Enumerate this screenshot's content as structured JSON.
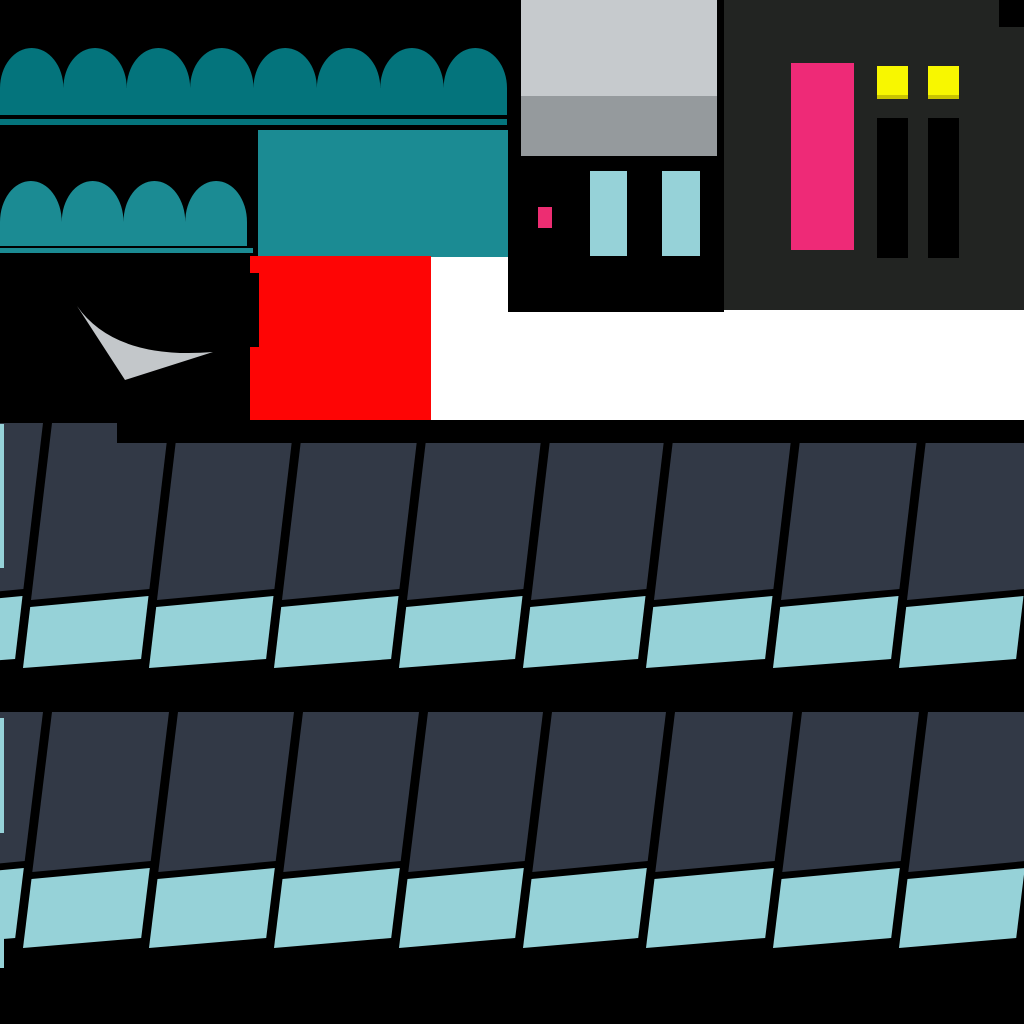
{
  "palette": {
    "black": "#000000",
    "white": "#ffffff",
    "awning_dark": "#04747c",
    "awning_mid": "#1b8b93",
    "canopy": "#1b8b93",
    "window_light": "#c6cacd",
    "window_mid": "#959a9d",
    "building": "#222422",
    "door_pink": "#ee2a77",
    "window_yellow": "#f8f700",
    "yellow_shade": "#c9c400",
    "interior_pink": "#ed2d72",
    "interior_teal": "#96d2d8",
    "red": "#fe0505",
    "triangle_gray": "#c3c7ca",
    "panel_dark": "#323946",
    "panel_teal": "#96d2d8"
  },
  "canvas": {
    "width": 1024,
    "height": 1024
  },
  "white_backdrop": {
    "x": 431,
    "y": 255,
    "w": 593,
    "h": 165,
    "fill": "white"
  },
  "awning_large": {
    "x": 0,
    "span": 507,
    "bumps": 8,
    "top": 48,
    "valley": 88,
    "base_bottom": 115,
    "fill": "awning_dark",
    "underline": {
      "x": 0,
      "y": 119,
      "w": 507,
      "h": 6
    }
  },
  "awning_small": {
    "x": 0,
    "span": 247,
    "bumps": 4,
    "top": 181,
    "valley": 222,
    "base_bottom": 246,
    "fill": "awning_mid",
    "underline": {
      "x": 0,
      "y": 248,
      "w": 253,
      "h": 5
    }
  },
  "canopy_rect": {
    "x": 258,
    "y": 130,
    "w": 252,
    "h": 127,
    "fill": "canopy"
  },
  "storefront": {
    "frame": {
      "x": 508,
      "y": 0,
      "w": 216,
      "h": 312,
      "fill": "black"
    },
    "pane_top": {
      "x": 521,
      "y": 0,
      "w": 196,
      "h": 96,
      "fill": "window_light"
    },
    "pane_bottom": {
      "x": 521,
      "y": 96,
      "w": 196,
      "h": 60,
      "fill": "window_mid"
    },
    "pink_box": {
      "x": 538,
      "y": 207,
      "w": 14,
      "h": 21,
      "fill": "interior_pink"
    },
    "teal_bars": [
      {
        "x": 590,
        "y": 171,
        "w": 37,
        "h": 85,
        "fill": "interior_teal"
      },
      {
        "x": 662,
        "y": 171,
        "w": 38,
        "h": 85,
        "fill": "interior_teal"
      }
    ]
  },
  "building": {
    "body": {
      "x": 724,
      "y": 0,
      "w": 300,
      "h": 310,
      "fill": "building"
    },
    "corner_notch": {
      "x": 999,
      "y": 0,
      "w": 25,
      "h": 27,
      "fill": "black"
    },
    "door": {
      "x": 791,
      "y": 63,
      "w": 63,
      "h": 187,
      "fill": "door_pink"
    },
    "windows": [
      {
        "x": 877,
        "y": 66,
        "w": 31,
        "h": 33,
        "fill": "window_yellow"
      },
      {
        "x": 928,
        "y": 66,
        "w": 31,
        "h": 33,
        "fill": "window_yellow"
      }
    ],
    "window_shade_h": 4,
    "pillars": [
      {
        "x": 877,
        "y": 118,
        "w": 31,
        "h": 140,
        "fill": "black"
      },
      {
        "x": 928,
        "y": 118,
        "w": 31,
        "h": 140,
        "fill": "black"
      }
    ]
  },
  "red_block": {
    "rect": {
      "x": 250,
      "y": 256,
      "w": 181,
      "h": 164,
      "fill": "red"
    },
    "notch": {
      "x": 250,
      "y": 273,
      "w": 9,
      "h": 74,
      "fill": "black"
    }
  },
  "paper_triangle": {
    "path": "M 77 306 Q 115 360 213 352 L 125 380 Z",
    "fill": "triangle_gray"
  },
  "panel_rows": {
    "gaps": [
      -78,
      47,
      173,
      298,
      423,
      547,
      670,
      797,
      923,
      1048
    ],
    "inset_left": 5,
    "inset_right": 4,
    "slant": 29,
    "dark_fill": "panel_dark",
    "teal_fill": "panel_teal",
    "rows": [
      {
        "top": 423,
        "dark_bot": [
          600,
          589
        ],
        "teal_top": [
          607,
          596
        ],
        "bottom": [
          668,
          659
        ]
      },
      {
        "top": 712,
        "dark_bot": [
          872,
          861
        ],
        "teal_top": [
          879,
          868
        ],
        "bottom": [
          948,
          938
        ]
      }
    ]
  },
  "top_black_bar": {
    "x": 117,
    "y": 420,
    "w": 907,
    "h": 23,
    "fill": "black"
  },
  "edge_slivers": [
    {
      "x": 0,
      "y": 424,
      "w": 4,
      "h": 144,
      "fill": "panel_teal"
    },
    {
      "x": 0,
      "y": 718,
      "w": 4,
      "h": 115,
      "fill": "panel_teal"
    },
    {
      "x": 0,
      "y": 880,
      "w": 4,
      "h": 88,
      "fill": "panel_teal"
    }
  ]
}
